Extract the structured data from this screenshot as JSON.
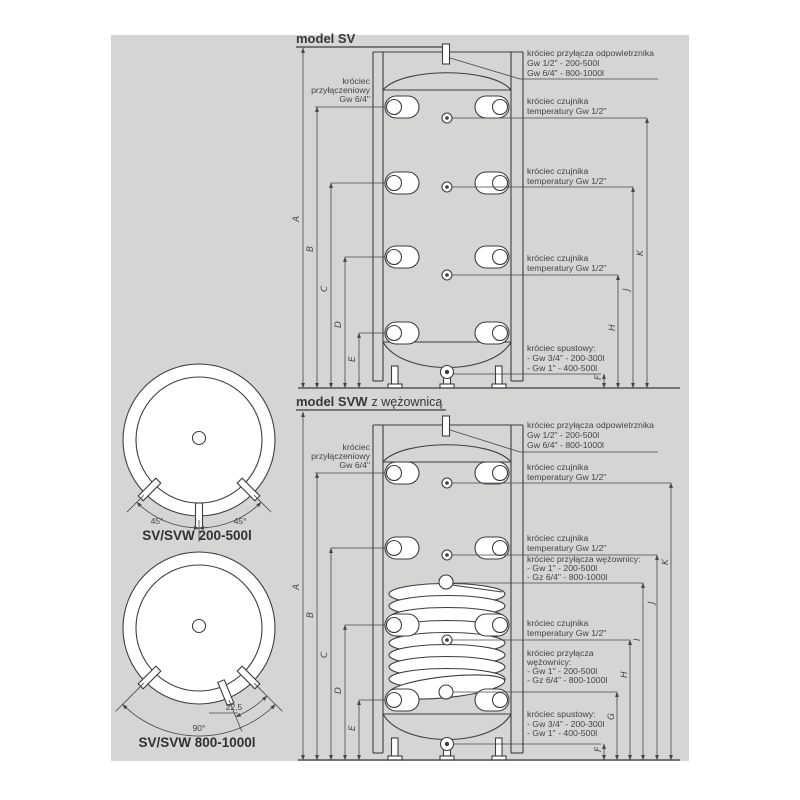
{
  "colors": {
    "panel": "#d5d5d3",
    "line": "#3a3f42",
    "dim": "#46484a",
    "text": "#414446"
  },
  "sv": {
    "title": "model SV",
    "left_port_label": [
      "króciec",
      "przyłączeniowy",
      "Gw 6/4\""
    ],
    "vent_label": [
      "króciec przyłącza odpowietrznika",
      "Gw 1/2\" - 200-500l",
      "Gw 6/4\" - 800-1000l"
    ],
    "sensor_label": [
      "króciec czujnika",
      "temperatury Gw 1/2\""
    ],
    "drain_label": [
      "króciec spustowy:",
      "- Gw 3/4\" - 200-300l",
      "- Gw 1\" - 400-500l"
    ],
    "dims_left": [
      "A",
      "B",
      "C",
      "D",
      "E"
    ],
    "dims_right": [
      "F",
      "H",
      "J",
      "K"
    ]
  },
  "svw": {
    "title_bold": "model SVW",
    "title_rest": "z wężownicą",
    "left_port_label": [
      "króciec",
      "przyłączeniowy",
      "Gw 6/4\""
    ],
    "vent_label": [
      "króciec przyłącza odpowietrznika",
      "Gw 1/2\" - 200-500l",
      "Gw 6/4\" - 800-1000l"
    ],
    "sensor_label": [
      "króciec czujnika",
      "temperatury Gw 1/2\""
    ],
    "coil_top_label": [
      "króciec przyłącza wężownicy:",
      "- Gw 1\" - 200-500l",
      "- Gz 6/4\" - 800-1000l"
    ],
    "coil_bottom_label": [
      "króciec przyłącza",
      "wężownicy:",
      "- Gw 1\" - 200-500l",
      "- Gz 6/4\" - 800-1000l"
    ],
    "drain_label": [
      "króciec spustowy:",
      "- Gw 3/4\" - 200-300l",
      "- Gw 1\" - 400-500l"
    ],
    "dims_left": [
      "A",
      "B",
      "C",
      "D",
      "E"
    ],
    "dims_right": [
      "F",
      "G",
      "H",
      "I",
      "J",
      "K"
    ]
  },
  "views": {
    "small": {
      "title": "SV/SVW 200-500l",
      "angle_left": "45°",
      "angle_right": "45°"
    },
    "large": {
      "title": "SV/SVW 800-1000l",
      "angle_small": "22,5",
      "angle_big": "90°"
    }
  }
}
